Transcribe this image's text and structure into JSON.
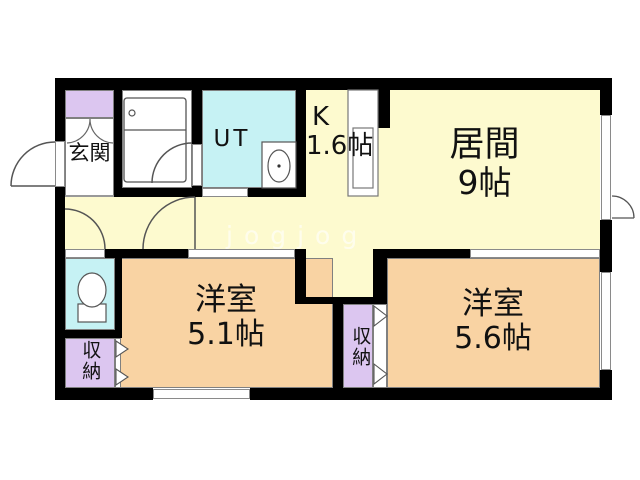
{
  "floorplan": {
    "watermark": "jogjog",
    "rooms": {
      "genkan": {
        "label": "玄関"
      },
      "ut": {
        "label": "UT"
      },
      "kitchen": {
        "label": "K",
        "size": "1.6帖"
      },
      "living": {
        "label": "居間",
        "size": "9帖"
      },
      "bedroom1": {
        "label": "洋室",
        "size": "5.1帖"
      },
      "bedroom2": {
        "label": "洋室",
        "size": "5.6帖"
      },
      "storage1": {
        "label": "収納"
      },
      "storage2": {
        "label": "収納"
      }
    },
    "colors": {
      "room_yellow": "#FDFACF",
      "room_orange": "#F9D3A3",
      "room_cyan": "#C6F2F4",
      "room_lavender": "#DCC6F0",
      "wall": "#000000"
    }
  }
}
